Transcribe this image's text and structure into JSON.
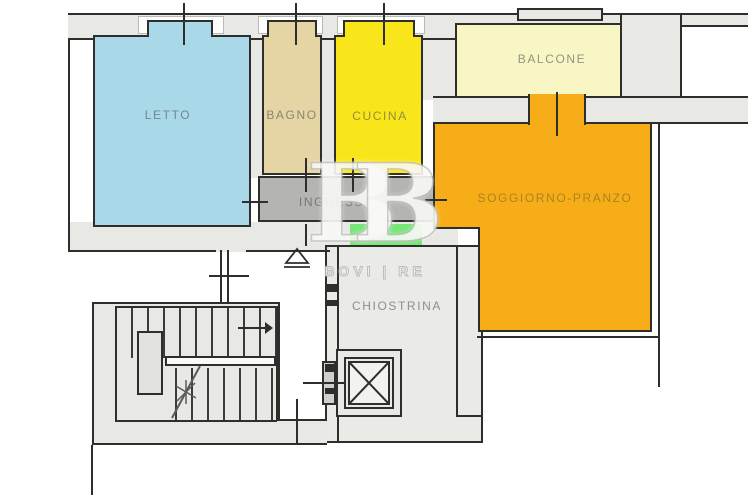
{
  "plan_title": "Apartment floor plan",
  "rooms": {
    "letto": {
      "label": "LETTO",
      "color": "#a9d8e9"
    },
    "bagno": {
      "label": "BAGNO",
      "color": "#e5d4a4"
    },
    "cucina": {
      "label": "CUCINA",
      "color": "#f9e61a"
    },
    "balcone": {
      "label": "BALCONE",
      "color": "#f8f6c5"
    },
    "soggiorno": {
      "label": "SOGGIORNO-PRANZO",
      "color": "#f6ad17"
    },
    "ingresso": {
      "label": "INGRESSO",
      "color": "#b4b4b1"
    },
    "chiostrina": {
      "label": "CHIOSTRINA",
      "color": "#eaeae7"
    }
  },
  "features": {
    "green_patch_color": "#77e577",
    "wall_fill": "#e8e8e5",
    "outline_color": "#2e2e2c",
    "stairwell": "stairs with up-arrow and break line",
    "elevator": "shaft with X cross"
  },
  "watermark": {
    "logo": "BB",
    "brand": "BOVI | RE"
  }
}
